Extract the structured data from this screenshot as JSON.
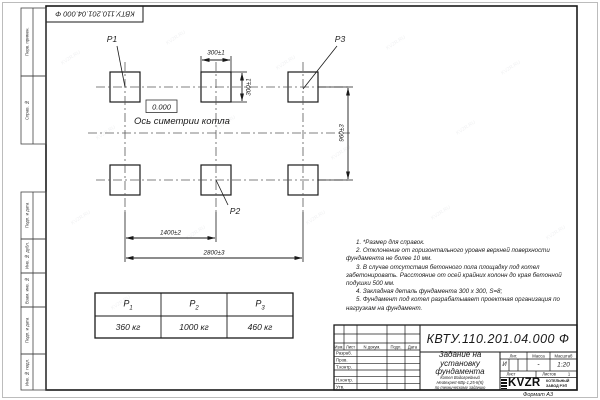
{
  "sheet": {
    "watermark": "KVZR.RU",
    "format_label": "Формат А3",
    "doc_number_rotated": "КВТУ.110.201.04.000 Ф",
    "margin_cells": [
      "Перв. примен.",
      "Справ. №",
      "Подп. и дата",
      "Инв. № дубл.",
      "Взам. инв. №",
      "Подп. и дата",
      "Инв. № подл."
    ]
  },
  "drawing": {
    "pad_labels": {
      "p1": "Р1",
      "p2": "Р2",
      "p3": "Р3"
    },
    "elevation_mark": "0.000",
    "axis_label": "Ось симетрии котла",
    "dim_pad_width": "300±1",
    "dim_pad_height": "300±1",
    "dim_rows": "960±3",
    "dim_mid": "1400±2",
    "dim_total": "2800±3"
  },
  "notes": [
    "1. *Размер для справок.",
    "2. Отклонение от горизонтального уровня верхней поверхности фундамента не более 10 мм.",
    "3. В случае отсутствия бетонного пола площадку под котел забетонировать. Расстояние от осей крайних колонн до края бетонной подушки 500 мм.",
    "4. Закладная деталь фундамента 300 х 300, S=8;",
    "5. Фундамент под котел разрабатывает проектная организация по нагрузкам на фундамент."
  ],
  "load_table": {
    "cols": [
      {
        "sym": "Р",
        "sub": "1",
        "value": "360 кг"
      },
      {
        "sym": "Р",
        "sub": "2",
        "value": "1000 кг"
      },
      {
        "sym": "Р",
        "sub": "3",
        "value": "460 кг"
      }
    ]
  },
  "title_block": {
    "doc_number": "КВТУ.110.201.04.000  Ф",
    "title": "Задание на установку фундамента",
    "subtitle_lines": [
      "Котел Водогрейный",
      "Heatexpert-КВр-1,25-К(К)",
      "по техническому заданию"
    ],
    "header_cells": [
      "Изм.",
      "Лист",
      "N докум.",
      "Подп.",
      "Дата"
    ],
    "row_labels": [
      "Разраб.",
      "Пров.",
      "Т.контр.",
      "Н.контр.",
      "Утв."
    ],
    "lit_label": "Лит.",
    "lit_value": "И",
    "mass_label": "Масса",
    "mass_value": "-",
    "scale_label": "Масштаб",
    "scale_value": "1:20",
    "sheet_label": "Лист",
    "sheets_label": "Листов",
    "sheets_value": "1",
    "logo_text": "KVZR",
    "company_lines": [
      "КОТЕЛЬНЫЙ",
      "ЗАВОД РЭП"
    ]
  }
}
